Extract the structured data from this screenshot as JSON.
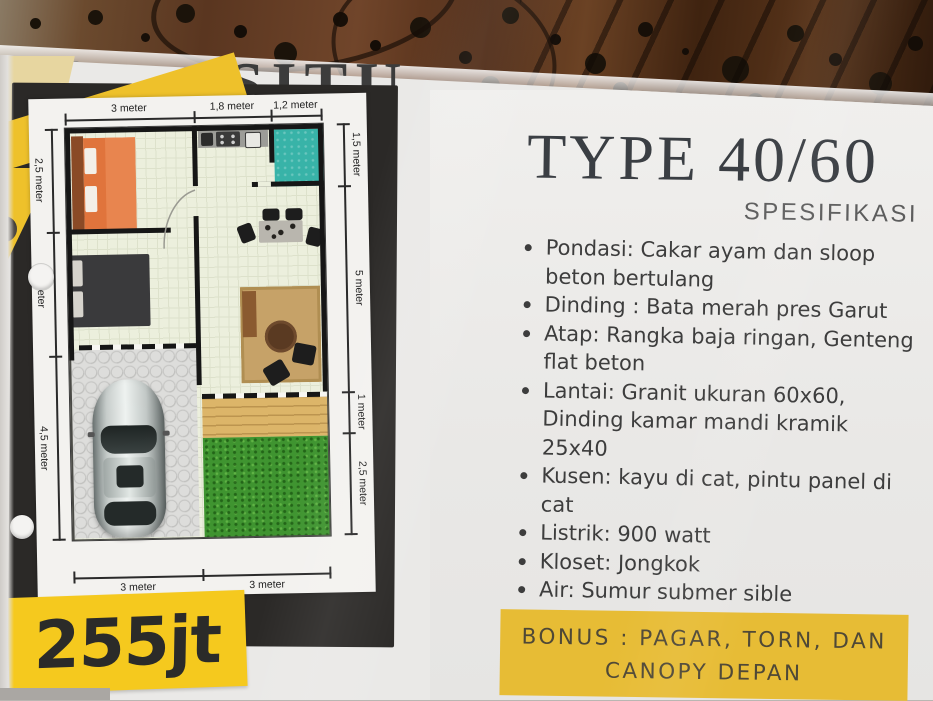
{
  "flyer": {
    "partial_header_text": "SITU",
    "title": "TYPE 40/60",
    "subtitle": "SPESIFIKASI",
    "specs": {
      "items": [
        [
          "Pondasi:  Cakar ayam dan sloop",
          "beton bertulang"
        ],
        [
          "Dinding : Bata merah pres Garut"
        ],
        [
          "Atap: Rangka baja ringan, Genteng",
          "flat beton"
        ],
        [
          "Lantai: Granit ukuran 60x60,",
          "Dinding kamar mandi kramik 25x40"
        ],
        [
          "Kusen: kayu di cat, pintu panel di",
          "cat"
        ],
        [
          "Listrik: 900 watt"
        ],
        [
          "Kloset: Jongkok"
        ],
        [
          "Air: Sumur submer sible"
        ],
        [
          "Kepemilikan: AJB+IMB"
        ]
      ]
    },
    "bonus": {
      "line1": "BONUS : PAGAR, TORN, DAN",
      "line2": "CANOPY DEPAN"
    },
    "price": "255jt",
    "floorplan": {
      "dimensions": {
        "top": [
          "3 meter",
          "1,8 meter",
          "1,2 meter"
        ],
        "left": [
          "2,5 meter",
          "meter",
          "4,5 meter"
        ],
        "right": [
          "1,5 meter",
          "5 meter",
          "1 meter",
          "2,5 meter"
        ],
        "bottom": [
          "3 meter",
          "3 meter"
        ]
      }
    },
    "colors": {
      "accent_yellow": "#f5c91e",
      "bonus_yellow": "#e7bc35",
      "panel_black": "#2b2927",
      "bathroom_teal": "#38b3a8",
      "grass_green": "#3f9430",
      "bed_orange": "#e0743c",
      "deck_tan": "#dcb569"
    }
  }
}
